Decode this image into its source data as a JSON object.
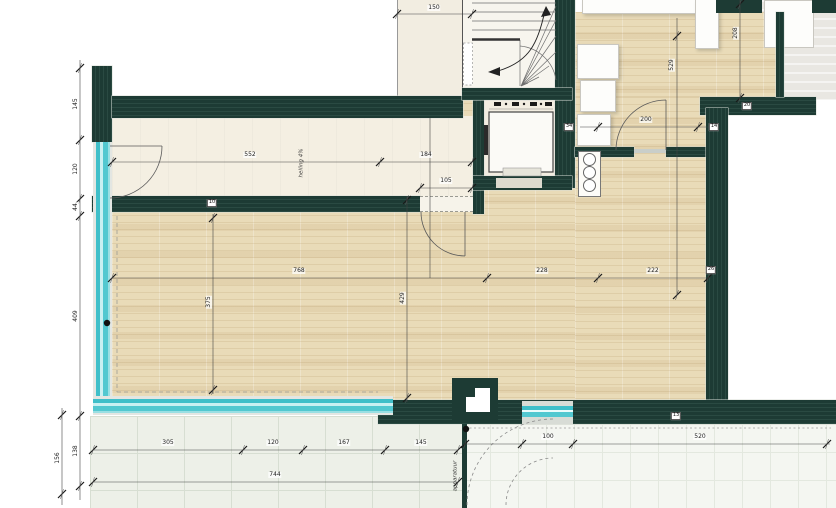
{
  "drawing": {
    "kind": "architectural floor plan",
    "colors": {
      "wall": "#1d3b34",
      "glass": "#3fbfc9",
      "wood_floor": "#e9dbb8",
      "hall_floor": "#f4efe2",
      "terrace": "#edf0e8",
      "outside": "#e9e7e2"
    }
  },
  "annotations": [
    {
      "id": "ramp-slope",
      "text": "helling 4%",
      "x": 302,
      "y": 163,
      "rot": -90
    },
    {
      "id": "equipment",
      "text": "apparatuur",
      "x": 456,
      "y": 476,
      "rot": -90
    }
  ],
  "dim_labels": [
    {
      "text": "150",
      "x": 434,
      "y": 8,
      "rot": 0
    },
    {
      "text": "552",
      "x": 250,
      "y": 155,
      "rot": 0
    },
    {
      "text": "184",
      "x": 426,
      "y": 155,
      "rot": 0
    },
    {
      "text": "105",
      "x": 446,
      "y": 181,
      "rot": 0
    },
    {
      "text": "768",
      "x": 299,
      "y": 271,
      "rot": 0
    },
    {
      "text": "228",
      "x": 542,
      "y": 271,
      "rot": 0
    },
    {
      "text": "222",
      "x": 653,
      "y": 271,
      "rot": 0
    },
    {
      "text": "200",
      "x": 646,
      "y": 120,
      "rot": 0
    },
    {
      "text": "305",
      "x": 168,
      "y": 443,
      "rot": 0
    },
    {
      "text": "120",
      "x": 273,
      "y": 443,
      "rot": 0
    },
    {
      "text": "167",
      "x": 344,
      "y": 443,
      "rot": 0
    },
    {
      "text": "145",
      "x": 421,
      "y": 443,
      "rot": 0
    },
    {
      "text": "744",
      "x": 275,
      "y": 475,
      "rot": 0
    },
    {
      "text": "100",
      "x": 548,
      "y": 437,
      "rot": 0
    },
    {
      "text": "520",
      "x": 700,
      "y": 437,
      "rot": 0
    },
    {
      "text": "145",
      "x": 76,
      "y": 104,
      "rot": -90
    },
    {
      "text": "120",
      "x": 76,
      "y": 169,
      "rot": -90
    },
    {
      "text": "44",
      "x": 76,
      "y": 207,
      "rot": -90
    },
    {
      "text": "409",
      "x": 76,
      "y": 316,
      "rot": -90
    },
    {
      "text": "138",
      "x": 76,
      "y": 451,
      "rot": -90
    },
    {
      "text": "156",
      "x": 58,
      "y": 458,
      "rot": -90
    },
    {
      "text": "529",
      "x": 672,
      "y": 65,
      "rot": -90
    },
    {
      "text": "208",
      "x": 736,
      "y": 33,
      "rot": -90
    },
    {
      "text": "375",
      "x": 209,
      "y": 302,
      "rot": -90
    },
    {
      "text": "429",
      "x": 403,
      "y": 298,
      "rot": -90
    }
  ],
  "wall_labels": [
    {
      "text": "10",
      "x": 212,
      "y": 203
    },
    {
      "text": "34",
      "x": 569,
      "y": 127
    },
    {
      "text": "14",
      "x": 714,
      "y": 127
    },
    {
      "text": "20",
      "x": 747,
      "y": 106
    },
    {
      "text": "26",
      "x": 711,
      "y": 270
    },
    {
      "text": "13",
      "x": 676,
      "y": 416
    }
  ]
}
